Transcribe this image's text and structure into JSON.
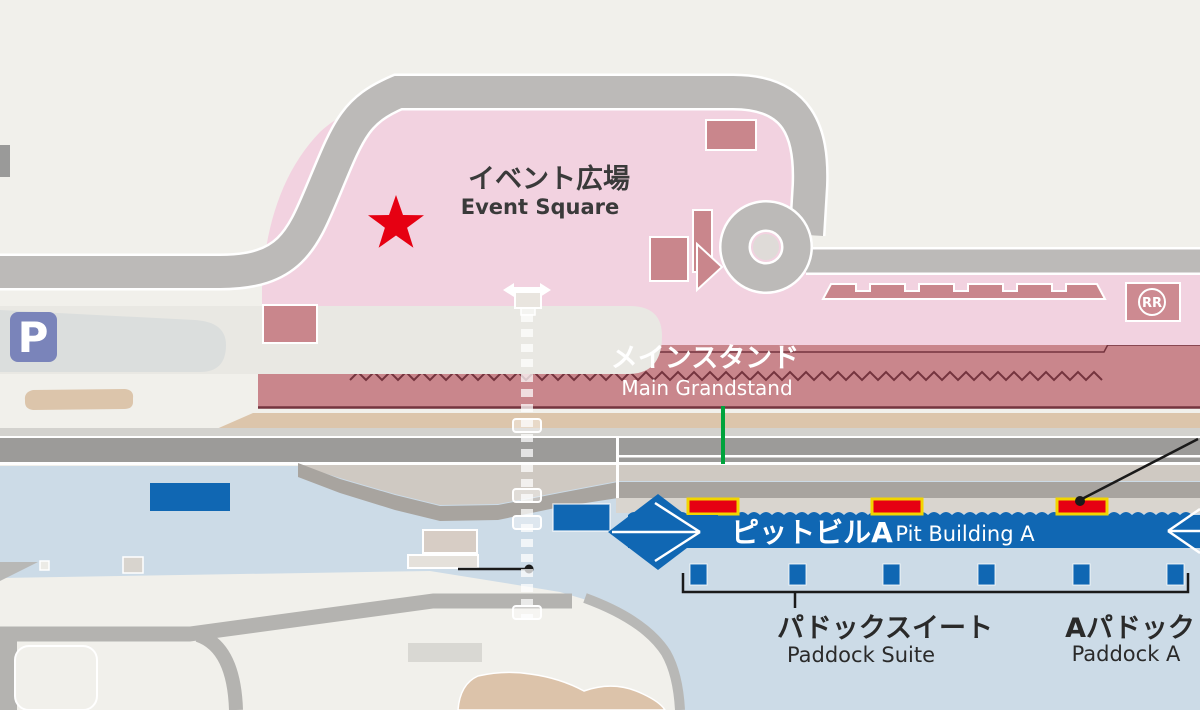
{
  "map": {
    "areas": {
      "event_square": {
        "label_ja": "イベント広場",
        "label_en": "Event Square"
      },
      "main_grandstand": {
        "label_ja": "メインスタンド",
        "label_en": "Main Grandstand"
      },
      "pit_building_a": {
        "label_ja": "ピットビルA",
        "label_en": "Pit Building A"
      },
      "paddock_suite": {
        "label_ja": "パドックスイート",
        "label_en": "Paddock Suite"
      },
      "paddock_a": {
        "label_ja": "Aパドック",
        "label_en": "Paddock A"
      }
    },
    "badges": {
      "parking": "P",
      "rest_room": "RR"
    },
    "colors": {
      "background": "#f1f0eb",
      "event_square_pink": "#f2d2e0",
      "building_rose": "#c9868c",
      "zigzag_dark": "#74343e",
      "road_gray": "#bcbab8",
      "track_gray": "#9c9b99",
      "pitlane_gray": "#a8a49f",
      "apron_warm_gray": "#d9d5cf",
      "paddock_light_blue": "#ccdbe7",
      "facility_blue": "#1067b3",
      "tan_path": "#dcc5ab",
      "marker_red": "#e60012",
      "marker_yellow": "#f2d500",
      "gate_green": "#00a33c",
      "parking_badge_blue": "#7a84ba",
      "annotation_black": "#1a1a1a"
    }
  }
}
